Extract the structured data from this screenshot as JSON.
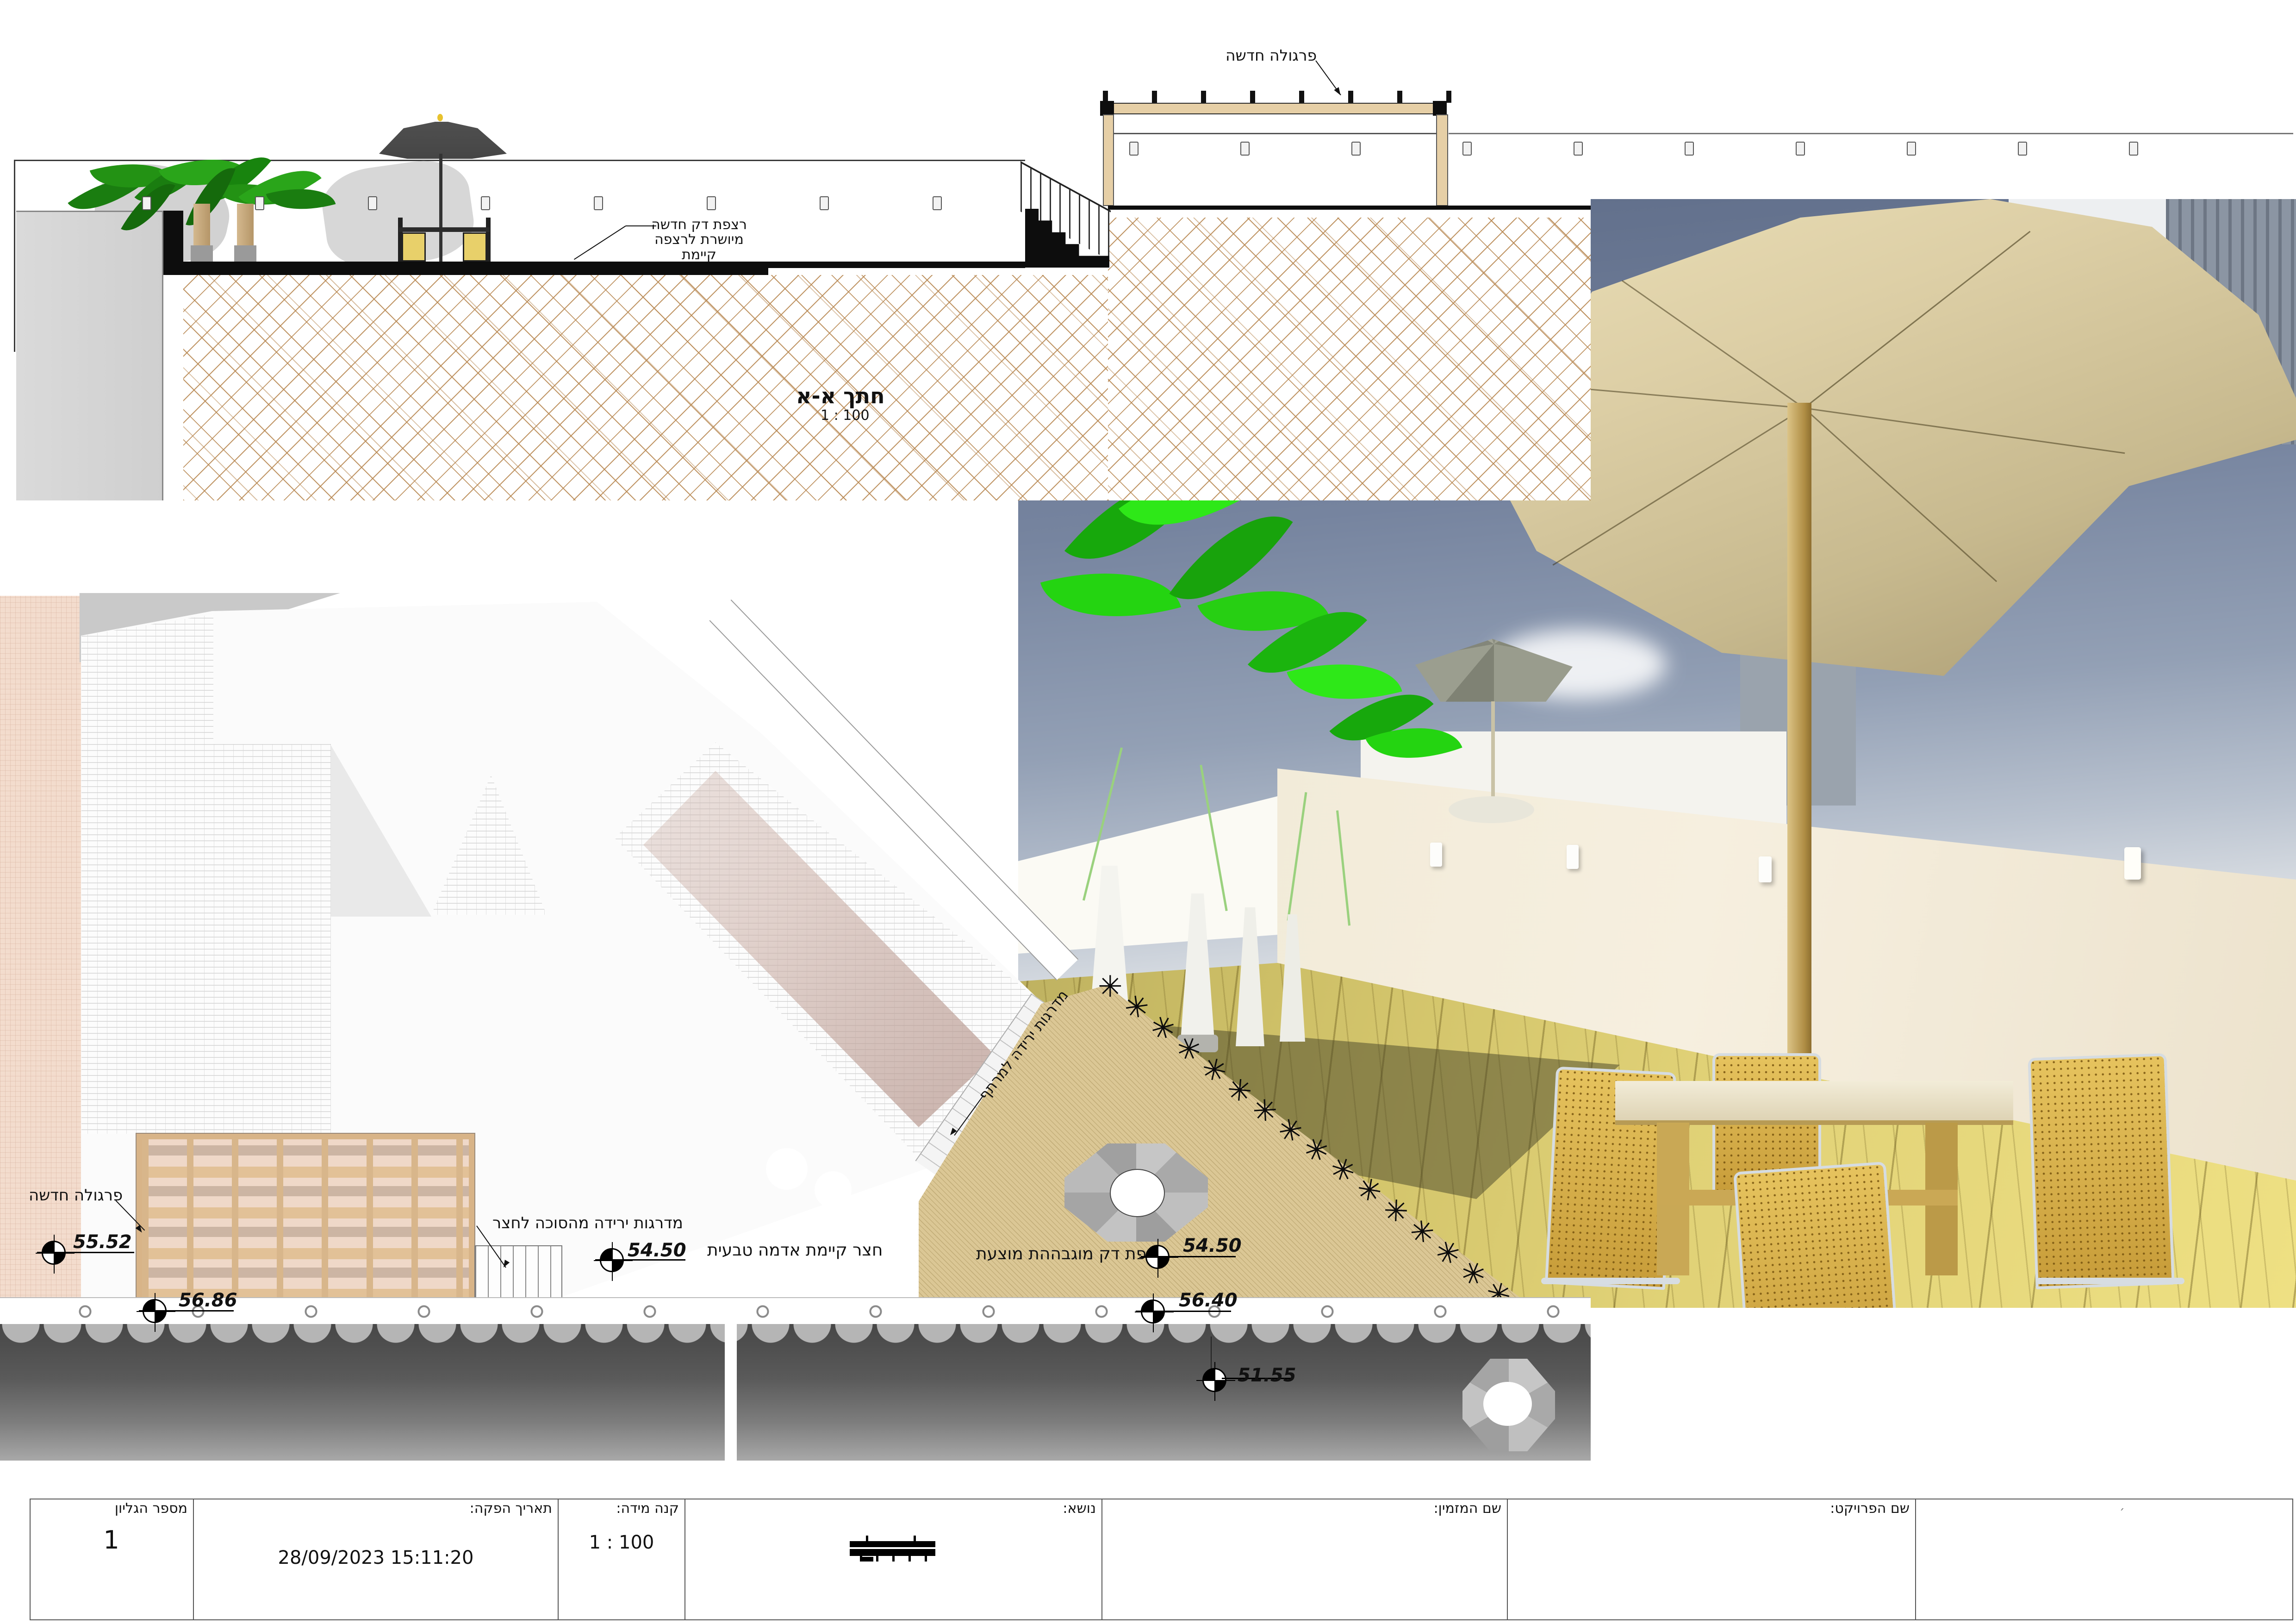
{
  "section": {
    "title": "חתך א-א",
    "scale": "1 : 100",
    "labels": {
      "pergola": "פרגולה חדשה",
      "deck_l1": "רצפת דק חדשה",
      "deck_l2": "מיושרת לרצפה קיימת"
    },
    "pergola_post_count": 8,
    "sconces_left_count": 8,
    "sconces_right_count": 10
  },
  "plan": {
    "labels": {
      "pergola": "פרגולה חדשה",
      "sukkah_stairs": "מדרגות ירידה מהסוכה לחצר",
      "yard": "חצר קיימת אדמה טבעית",
      "basement_stairs": "מדרגות ירידה למרתף",
      "deck": "רצפת דק מוגבההת מוצעת"
    },
    "spot_elevations": [
      {
        "value": "55.52",
        "location": "pergola-area"
      },
      {
        "value": "56.86",
        "location": "pergola-south-edge"
      },
      {
        "value": "54.50",
        "location": "existing-yard"
      },
      {
        "value": "54.50",
        "location": "proposed-deck"
      },
      {
        "value": "56.40",
        "location": "boundary-wall"
      },
      {
        "value": "51.55",
        "location": "street-below"
      }
    ],
    "plant_row": {
      "glyph": "✳",
      "count": 16
    }
  },
  "titleblock": {
    "cells": [
      {
        "name": "sheet-number",
        "label": "מספר הגליון",
        "value": "1"
      },
      {
        "name": "issue-date",
        "label": "תאריך הפקה:",
        "value": "28/09/2023 15:11:20"
      },
      {
        "name": "scale",
        "label": "קנה מידה:",
        "value": "1 : 100"
      },
      {
        "name": "subject",
        "label": "נושא:",
        "value": ""
      },
      {
        "name": "client-name",
        "label": "שם המזמין:",
        "value": ""
      },
      {
        "name": "project-name",
        "label": "שם הפרויקט:",
        "value": ""
      },
      {
        "name": "corner-note",
        "label": "",
        "value": "׳"
      }
    ]
  },
  "colors": {
    "pergola_wood": "#e6cfa6",
    "hatch_line": "#b98a55",
    "plan_pink": "#f3dccd",
    "plan_deck_tan": "#dbc795",
    "street_band_dark": "#4a4a4a",
    "render_sky": "#64748f",
    "render_leaf": "#25c312",
    "render_canopy": "#d8cba4",
    "render_gold": "#d9b54a"
  }
}
